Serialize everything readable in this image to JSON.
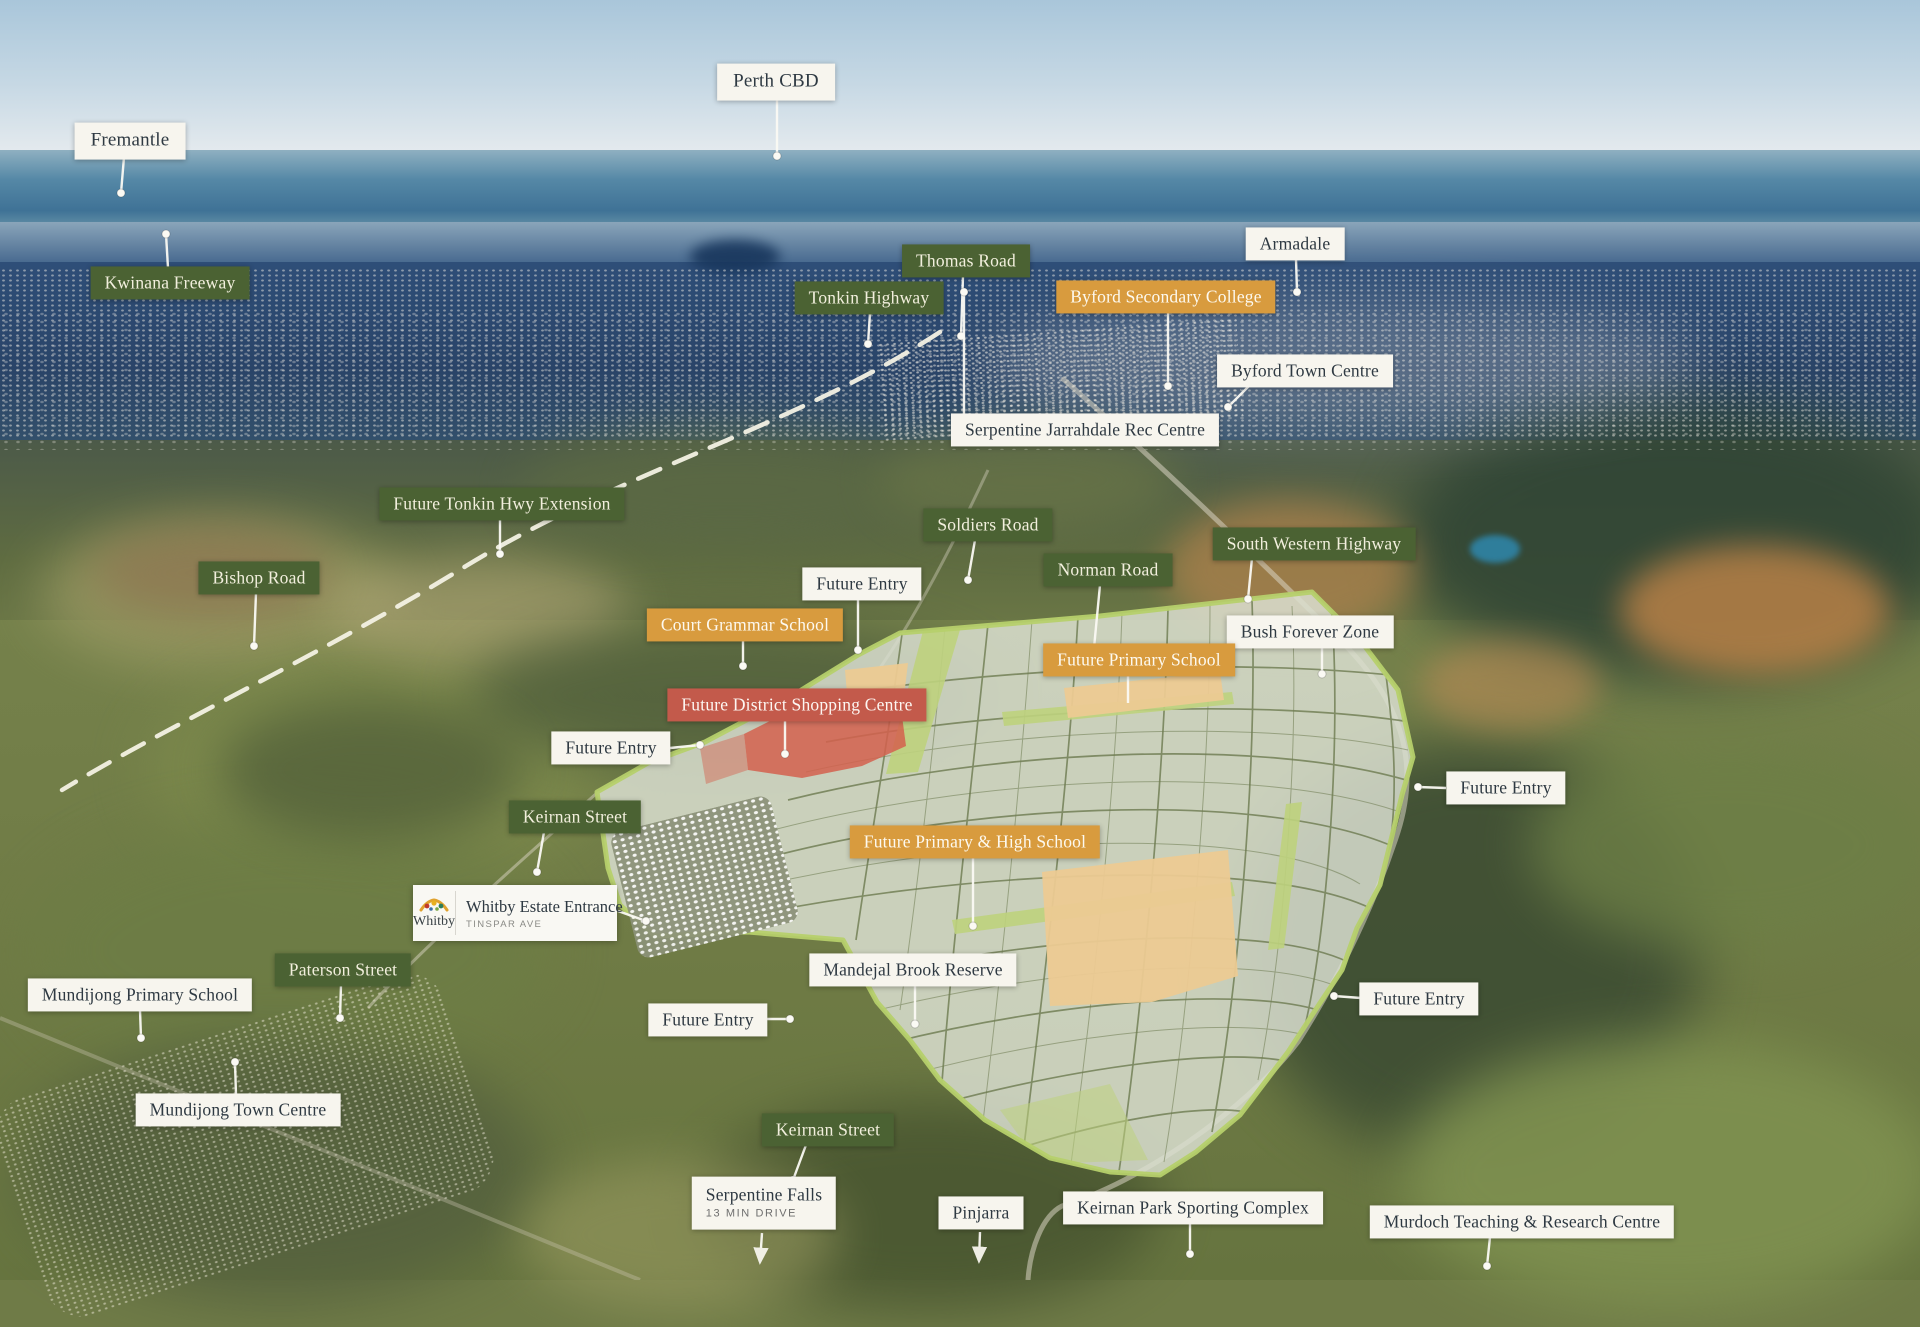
{
  "title": "Whitby estate aerial location map",
  "colors": {
    "label_green": "#4b6233",
    "label_orange": "#d89b3e",
    "label_red": "#c35a4b",
    "label_white": "#f7f5ee",
    "estate_boundary": "#b6d06c",
    "leader_line": "#fbfaf4"
  },
  "whitby_card": {
    "logo_text": "Whitby",
    "title": "Whitby Estate Entrance",
    "subtitle": "TINSPAR AVE",
    "leader": {
      "x1": 618,
      "y1": 911,
      "x2": 646,
      "y2": 921,
      "end": "dot"
    }
  },
  "labels": [
    {
      "id": "fremantle",
      "text": "Fremantle",
      "type": "white",
      "size": "big",
      "cx": 130,
      "cy": 141,
      "leader": {
        "x1": 124,
        "y1": 157,
        "x2": 121,
        "y2": 193,
        "end": "dot"
      }
    },
    {
      "id": "perth-cbd",
      "text": "Perth CBD",
      "type": "white",
      "size": "big",
      "cx": 776,
      "cy": 82,
      "leader": {
        "x1": 777,
        "y1": 96,
        "x2": 777,
        "y2": 156,
        "end": "dot"
      }
    },
    {
      "id": "kwinana-freeway",
      "text": "Kwinana Freeway",
      "type": "green",
      "cx": 170,
      "cy": 283,
      "leader": {
        "x1": 168,
        "y1": 268,
        "x2": 166,
        "y2": 234,
        "end": "dot"
      }
    },
    {
      "id": "thomas-road",
      "text": "Thomas Road",
      "type": "green",
      "cx": 966,
      "cy": 261,
      "leader": {
        "x1": 963,
        "y1": 276,
        "x2": 961,
        "y2": 336,
        "end": "dot"
      }
    },
    {
      "id": "tonkin-highway",
      "text": "Tonkin Highway",
      "type": "green",
      "cx": 869,
      "cy": 298,
      "leader": {
        "x1": 870,
        "y1": 313,
        "x2": 868,
        "y2": 344,
        "end": "dot"
      }
    },
    {
      "id": "byford-secondary-college",
      "text": "Byford Secondary College",
      "type": "orange",
      "cx": 1166,
      "cy": 297,
      "leader": {
        "x1": 1168,
        "y1": 312,
        "x2": 1168,
        "y2": 386,
        "end": "dot"
      }
    },
    {
      "id": "armadale",
      "text": "Armadale",
      "type": "white",
      "cx": 1295,
      "cy": 244,
      "leader": {
        "x1": 1296,
        "y1": 259,
        "x2": 1297,
        "y2": 292,
        "end": "dot"
      }
    },
    {
      "id": "byford-town-centre",
      "text": "Byford Town Centre",
      "type": "white",
      "cx": 1305,
      "cy": 371,
      "leader": {
        "x1": 1250,
        "y1": 385,
        "x2": 1228,
        "y2": 407,
        "end": "dot"
      }
    },
    {
      "id": "serpentine-jarrahdale-rec-centre",
      "text": "Serpentine Jarrahdale Rec Centre",
      "type": "white",
      "cx": 1085,
      "cy": 430,
      "leader": {
        "x1": 964,
        "y1": 416,
        "x2": 964,
        "y2": 292,
        "end": "dot"
      }
    },
    {
      "id": "future-tonkin-hwy-extension",
      "text": "Future Tonkin Hwy Extension",
      "type": "green",
      "cx": 502,
      "cy": 504,
      "leader": {
        "x1": 500,
        "y1": 519,
        "x2": 500,
        "y2": 554,
        "end": "dot"
      }
    },
    {
      "id": "bishop-road",
      "text": "Bishop Road",
      "type": "green",
      "cx": 259,
      "cy": 578,
      "leader": {
        "x1": 256,
        "y1": 593,
        "x2": 254,
        "y2": 646,
        "end": "dot"
      }
    },
    {
      "id": "soldiers-road",
      "text": "Soldiers Road",
      "type": "green",
      "cx": 988,
      "cy": 525,
      "leader": {
        "x1": 975,
        "y1": 540,
        "x2": 968,
        "y2": 580,
        "end": "dot"
      }
    },
    {
      "id": "norman-road",
      "text": "Norman Road",
      "type": "green",
      "cx": 1108,
      "cy": 570,
      "leader": {
        "x1": 1100,
        "y1": 585,
        "x2": 1094,
        "y2": 648,
        "end": "dot"
      }
    },
    {
      "id": "south-western-highway",
      "text": "South Western Highway",
      "type": "green",
      "cx": 1314,
      "cy": 544,
      "leader": {
        "x1": 1252,
        "y1": 558,
        "x2": 1248,
        "y2": 599,
        "end": "dot"
      }
    },
    {
      "id": "future-entry-north",
      "text": "Future Entry",
      "type": "white",
      "cx": 862,
      "cy": 584,
      "leader": {
        "x1": 858,
        "y1": 599,
        "x2": 858,
        "y2": 650,
        "end": "dot"
      }
    },
    {
      "id": "court-grammar-school",
      "text": "Court Grammar School",
      "type": "orange",
      "cx": 745,
      "cy": 625,
      "leader": {
        "x1": 743,
        "y1": 640,
        "x2": 743,
        "y2": 666,
        "end": "dot"
      }
    },
    {
      "id": "bush-forever-zone",
      "text": "Bush Forever Zone",
      "type": "white",
      "cx": 1310,
      "cy": 632,
      "leader": {
        "x1": 1322,
        "y1": 647,
        "x2": 1322,
        "y2": 674,
        "end": "dot"
      }
    },
    {
      "id": "future-primary-school",
      "text": "Future Primary School",
      "type": "orange",
      "cx": 1139,
      "cy": 660,
      "leader": {
        "x1": 1128,
        "y1": 675,
        "x2": 1128,
        "y2": 703,
        "end": "none"
      }
    },
    {
      "id": "future-district-shopping-centre",
      "text": "Future District Shopping Centre",
      "type": "red",
      "cx": 797,
      "cy": 705,
      "leader": {
        "x1": 785,
        "y1": 720,
        "x2": 785,
        "y2": 754,
        "end": "dot"
      }
    },
    {
      "id": "future-entry-west",
      "text": "Future Entry",
      "type": "white",
      "cx": 611,
      "cy": 748,
      "leader": {
        "x1": 670,
        "y1": 748,
        "x2": 700,
        "y2": 745,
        "end": "dot"
      }
    },
    {
      "id": "future-entry-east-1",
      "text": "Future Entry",
      "type": "white",
      "cx": 1506,
      "cy": 788,
      "leader": {
        "x1": 1446,
        "y1": 788,
        "x2": 1418,
        "y2": 787,
        "end": "dot"
      }
    },
    {
      "id": "keirnan-street-north",
      "text": "Keirnan Street",
      "type": "green",
      "cx": 575,
      "cy": 817,
      "leader": {
        "x1": 544,
        "y1": 832,
        "x2": 537,
        "y2": 872,
        "end": "dot"
      }
    },
    {
      "id": "future-primary-high-school",
      "text": "Future Primary & High School",
      "type": "orange",
      "cx": 975,
      "cy": 842,
      "leader": {
        "x1": 973,
        "y1": 857,
        "x2": 973,
        "y2": 926,
        "end": "dot"
      }
    },
    {
      "id": "paterson-street",
      "text": "Paterson Street",
      "type": "green",
      "cx": 343,
      "cy": 970,
      "leader": {
        "x1": 341,
        "y1": 985,
        "x2": 340,
        "y2": 1018,
        "end": "dot"
      }
    },
    {
      "id": "mundijong-primary-school",
      "text": "Mundijong Primary School",
      "type": "white",
      "cx": 140,
      "cy": 995,
      "leader": {
        "x1": 140,
        "y1": 1010,
        "x2": 141,
        "y2": 1038,
        "end": "dot"
      }
    },
    {
      "id": "mandejal-brook-reserve",
      "text": "Mandejal Brook Reserve",
      "type": "white",
      "cx": 913,
      "cy": 970,
      "leader": {
        "x1": 915,
        "y1": 985,
        "x2": 915,
        "y2": 1024,
        "end": "dot"
      }
    },
    {
      "id": "future-entry-east-2",
      "text": "Future Entry",
      "type": "white",
      "cx": 1419,
      "cy": 999,
      "leader": {
        "x1": 1361,
        "y1": 998,
        "x2": 1334,
        "y2": 996,
        "end": "dot"
      }
    },
    {
      "id": "future-entry-south",
      "text": "Future Entry",
      "type": "white",
      "cx": 708,
      "cy": 1020,
      "leader": {
        "x1": 762,
        "y1": 1019,
        "x2": 790,
        "y2": 1019,
        "end": "dot"
      }
    },
    {
      "id": "mundijong-town-centre",
      "text": "Mundijong Town Centre",
      "type": "white",
      "cx": 238,
      "cy": 1110,
      "leader": {
        "x1": 236,
        "y1": 1095,
        "x2": 235,
        "y2": 1062,
        "end": "dot"
      }
    },
    {
      "id": "keirnan-street-south",
      "text": "Keirnan Street",
      "type": "green",
      "cx": 828,
      "cy": 1130,
      "leader": {
        "x1": 806,
        "y1": 1145,
        "x2": 793,
        "y2": 1180,
        "end": "dot"
      }
    },
    {
      "id": "serpentine-falls",
      "text": "Serpentine Falls",
      "subtext": "13 MIN DRIVE",
      "type": "white-card",
      "cx": 764,
      "cy": 1203,
      "leader": {
        "x1": 762,
        "y1": 1233,
        "x2": 760,
        "y2": 1262,
        "end": "arrow"
      }
    },
    {
      "id": "pinjarra",
      "text": "Pinjarra",
      "type": "white",
      "cx": 981,
      "cy": 1213,
      "leader": {
        "x1": 980,
        "y1": 1232,
        "x2": 979,
        "y2": 1261,
        "end": "arrow"
      }
    },
    {
      "id": "keirnan-park-sporting-complex",
      "text": "Keirnan Park Sporting Complex",
      "type": "white",
      "cx": 1193,
      "cy": 1208,
      "leader": {
        "x1": 1190,
        "y1": 1223,
        "x2": 1190,
        "y2": 1254,
        "end": "dot"
      }
    },
    {
      "id": "murdoch-teaching-research-centre",
      "text": "Murdoch Teaching & Research Centre",
      "type": "white",
      "cx": 1522,
      "cy": 1222,
      "leader": {
        "x1": 1490,
        "y1": 1237,
        "x2": 1487,
        "y2": 1266,
        "end": "dot"
      }
    }
  ]
}
